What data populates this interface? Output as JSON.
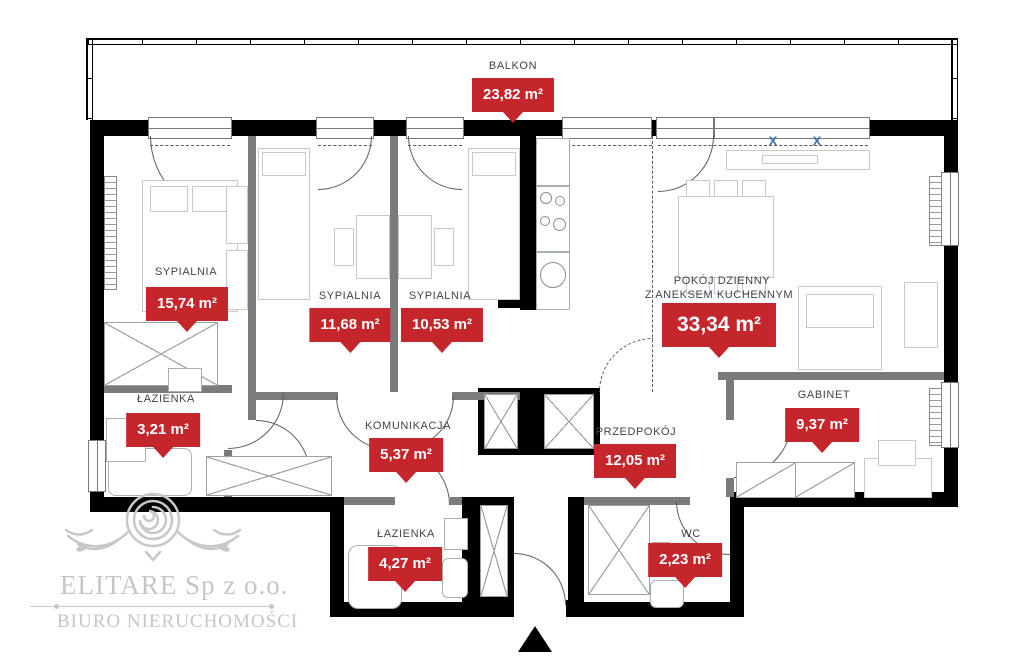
{
  "plan": {
    "balcony": {
      "label": "BALKON",
      "area": "23,82 m²"
    },
    "rooms": [
      {
        "id": "sypialnia-1",
        "label": "SYPIALNIA",
        "area": "15,74 m²"
      },
      {
        "id": "sypialnia-2",
        "label": "SYPIALNIA",
        "area": "11,68 m²"
      },
      {
        "id": "sypialnia-3",
        "label": "SYPIALNIA",
        "area": "10,53 m²"
      },
      {
        "id": "pokoj-dzienny",
        "label": "POKÓJ DZIENNY",
        "sublabel": "Z ANEKSEM KUCHENNYM",
        "area": "33,34 m²"
      },
      {
        "id": "lazienka-mala",
        "label": "ŁAZIENKA",
        "area": "3,21 m²"
      },
      {
        "id": "komunikacja",
        "label": "KOMUNIKACJA",
        "area": "5,37 m²"
      },
      {
        "id": "przedpokoj",
        "label": "PRZEDPOKÓJ",
        "area": "12,05 m²"
      },
      {
        "id": "gabinet",
        "label": "GABINET",
        "area": "9,37 m²"
      },
      {
        "id": "lazienka-duza",
        "label": "ŁAZIENKA",
        "area": "4,27 m²"
      },
      {
        "id": "wc",
        "label": "WC",
        "area": "2,23 m²"
      }
    ],
    "window_mark": "X",
    "colors": {
      "badge_red": "#c4262c",
      "label_gray": "#3e454c",
      "wall_black": "#000000",
      "wall_gray": "#7b7b7b",
      "window_mark_blue": "#3c6fb4",
      "watermark_gray": "#c6c6c6"
    }
  },
  "watermark": {
    "company": "ELITARE Sp z o.o.",
    "tagline": "BIURO NIERUCHOMOŚCI"
  }
}
